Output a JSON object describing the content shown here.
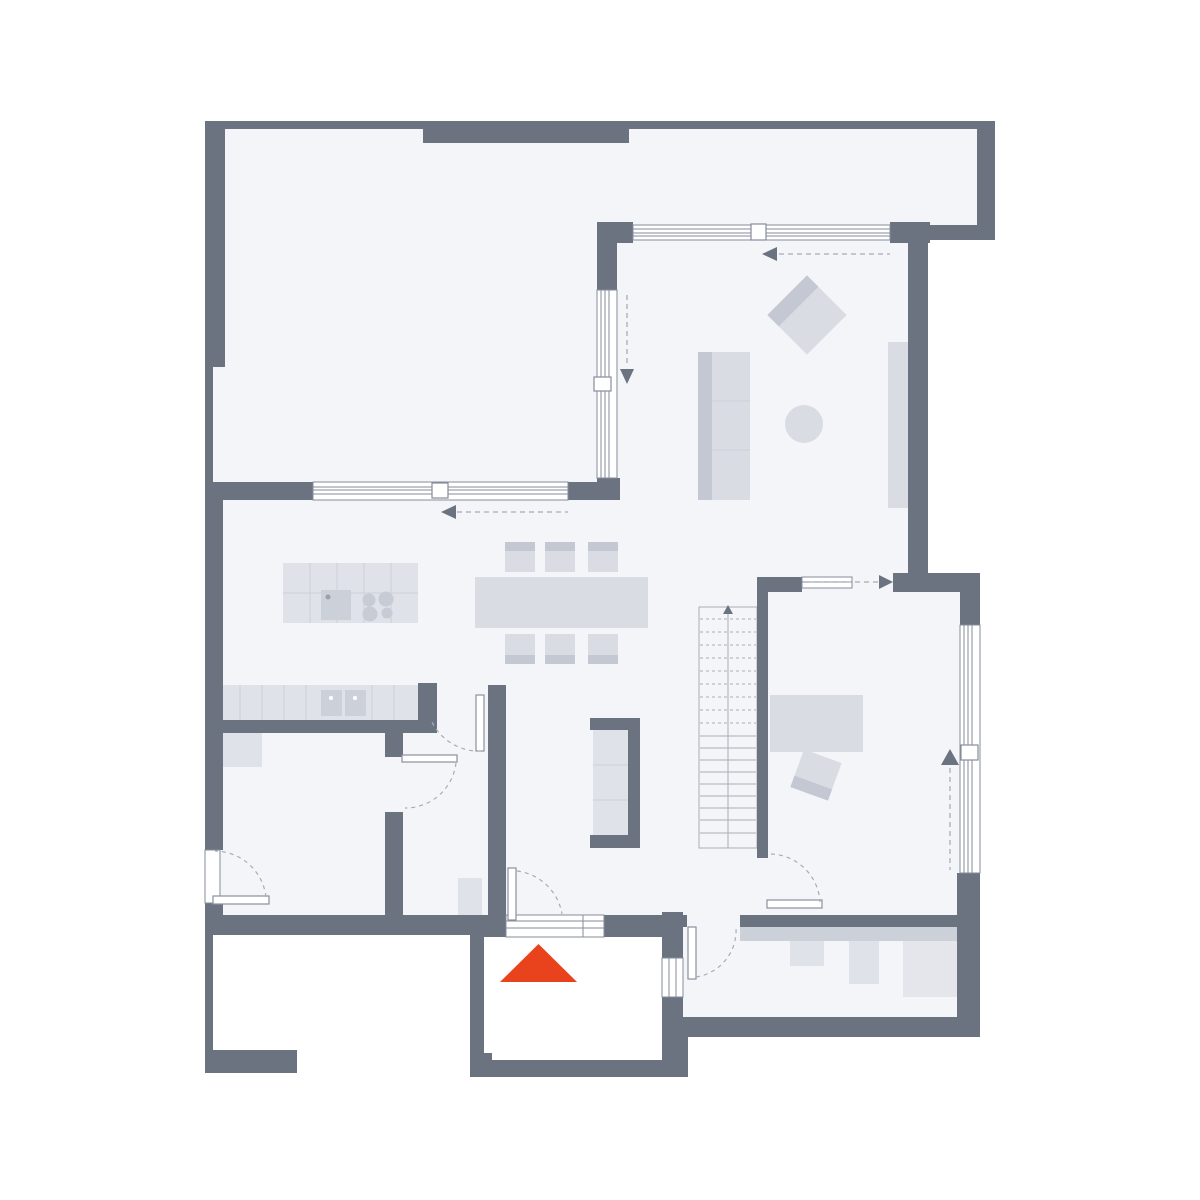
{
  "meta": {
    "type": "architectural-floor-plan",
    "description": "Ground floor plan, no text labels, furnished, entrance marked with red triangle"
  },
  "colors": {
    "background": "#ffffff",
    "floor": "#f4f5f8",
    "wall": "#6b7280",
    "furniture": "#d9dce3",
    "furnitureDark": "#c3c8d2",
    "furnitureLight": "#dfe2e8",
    "counter": "#dfe2e8",
    "counterLine": "#cdd1d9",
    "appliance": "#ccd0d9",
    "applianceLight": "#e4e6eb",
    "windowLine": "#868d9a",
    "leafLine": "#8a90a0",
    "dash": "#a7acb6",
    "stairLine": "#a8adb8",
    "entrance": "#e8431c"
  },
  "rooms": [
    {
      "id": "garage",
      "position": "top-left"
    },
    {
      "id": "living-room",
      "position": "top-right"
    },
    {
      "id": "kitchen-dining",
      "position": "center-left"
    },
    {
      "id": "hallway",
      "position": "center"
    },
    {
      "id": "bedroom-office",
      "position": "center-right"
    },
    {
      "id": "bathroom",
      "position": "bottom-left"
    },
    {
      "id": "storage-room",
      "position": "bottom-center-left"
    },
    {
      "id": "utility-room",
      "position": "bottom-right"
    },
    {
      "id": "entrance-porch",
      "position": "bottom-center",
      "floor_color": "white"
    },
    {
      "id": "carport-terrace",
      "position": "bottom-left-outside",
      "floor_color": "white"
    }
  ],
  "furniture": [
    {
      "id": "kitchen-island",
      "features": [
        "sink",
        "cooktop-4-burners"
      ]
    },
    {
      "id": "kitchen-counter",
      "features": [
        "double-sink"
      ]
    },
    {
      "id": "dining-table",
      "chairs": 6
    },
    {
      "id": "sofa",
      "seats": 3
    },
    {
      "id": "armchair",
      "rotated": true
    },
    {
      "id": "round-side-table"
    },
    {
      "id": "sideboard"
    },
    {
      "id": "hall-wardrobe",
      "shelves": 3
    },
    {
      "id": "desk-bed"
    },
    {
      "id": "desk-chair",
      "rotated": true
    },
    {
      "id": "utility-counter",
      "appliances": 3
    },
    {
      "id": "stairs",
      "treads": 18,
      "direction": "up"
    },
    {
      "id": "bath-cabinet"
    },
    {
      "id": "shoe-cabinet"
    }
  ],
  "markers": {
    "entrance_triangle": {
      "shape": "triangle-up",
      "color": "#e8431c"
    },
    "sliding_arrows": 5,
    "door_swings": 6
  }
}
